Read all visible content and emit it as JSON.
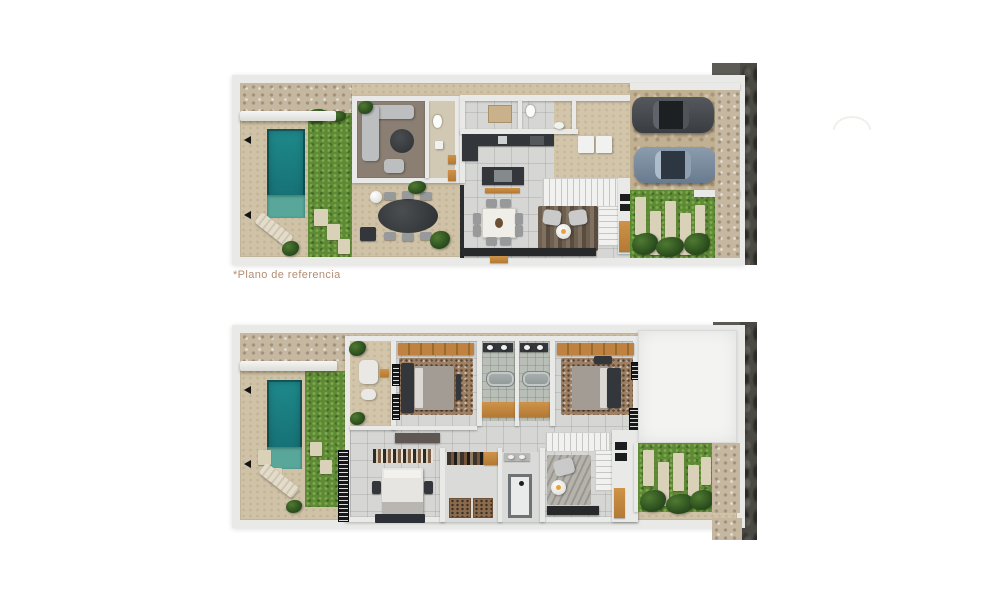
{
  "page": {
    "background": "#ffffff"
  },
  "caption": "*Plano de referencia",
  "colors": {
    "wall": "#e9eae8",
    "deck": "#cfc2a6",
    "drive": "#c2b092",
    "grass": "#5e8a36",
    "pool": "#1d8486",
    "poolLedge": "#58a79a",
    "wood": "#c08240",
    "woodFloor": "#8b7f73",
    "tile": "#d6d7d5",
    "bathTile": "#b9bfb7",
    "stone": "#c5b7a0",
    "darkWall": "#4b4944",
    "darkFurn": "#33363a",
    "marble": "#efeee8",
    "carDark": "#3f4246",
    "carBlue": "#748799",
    "roof": "#f3f4f2",
    "caption": "#b28d73"
  }
}
